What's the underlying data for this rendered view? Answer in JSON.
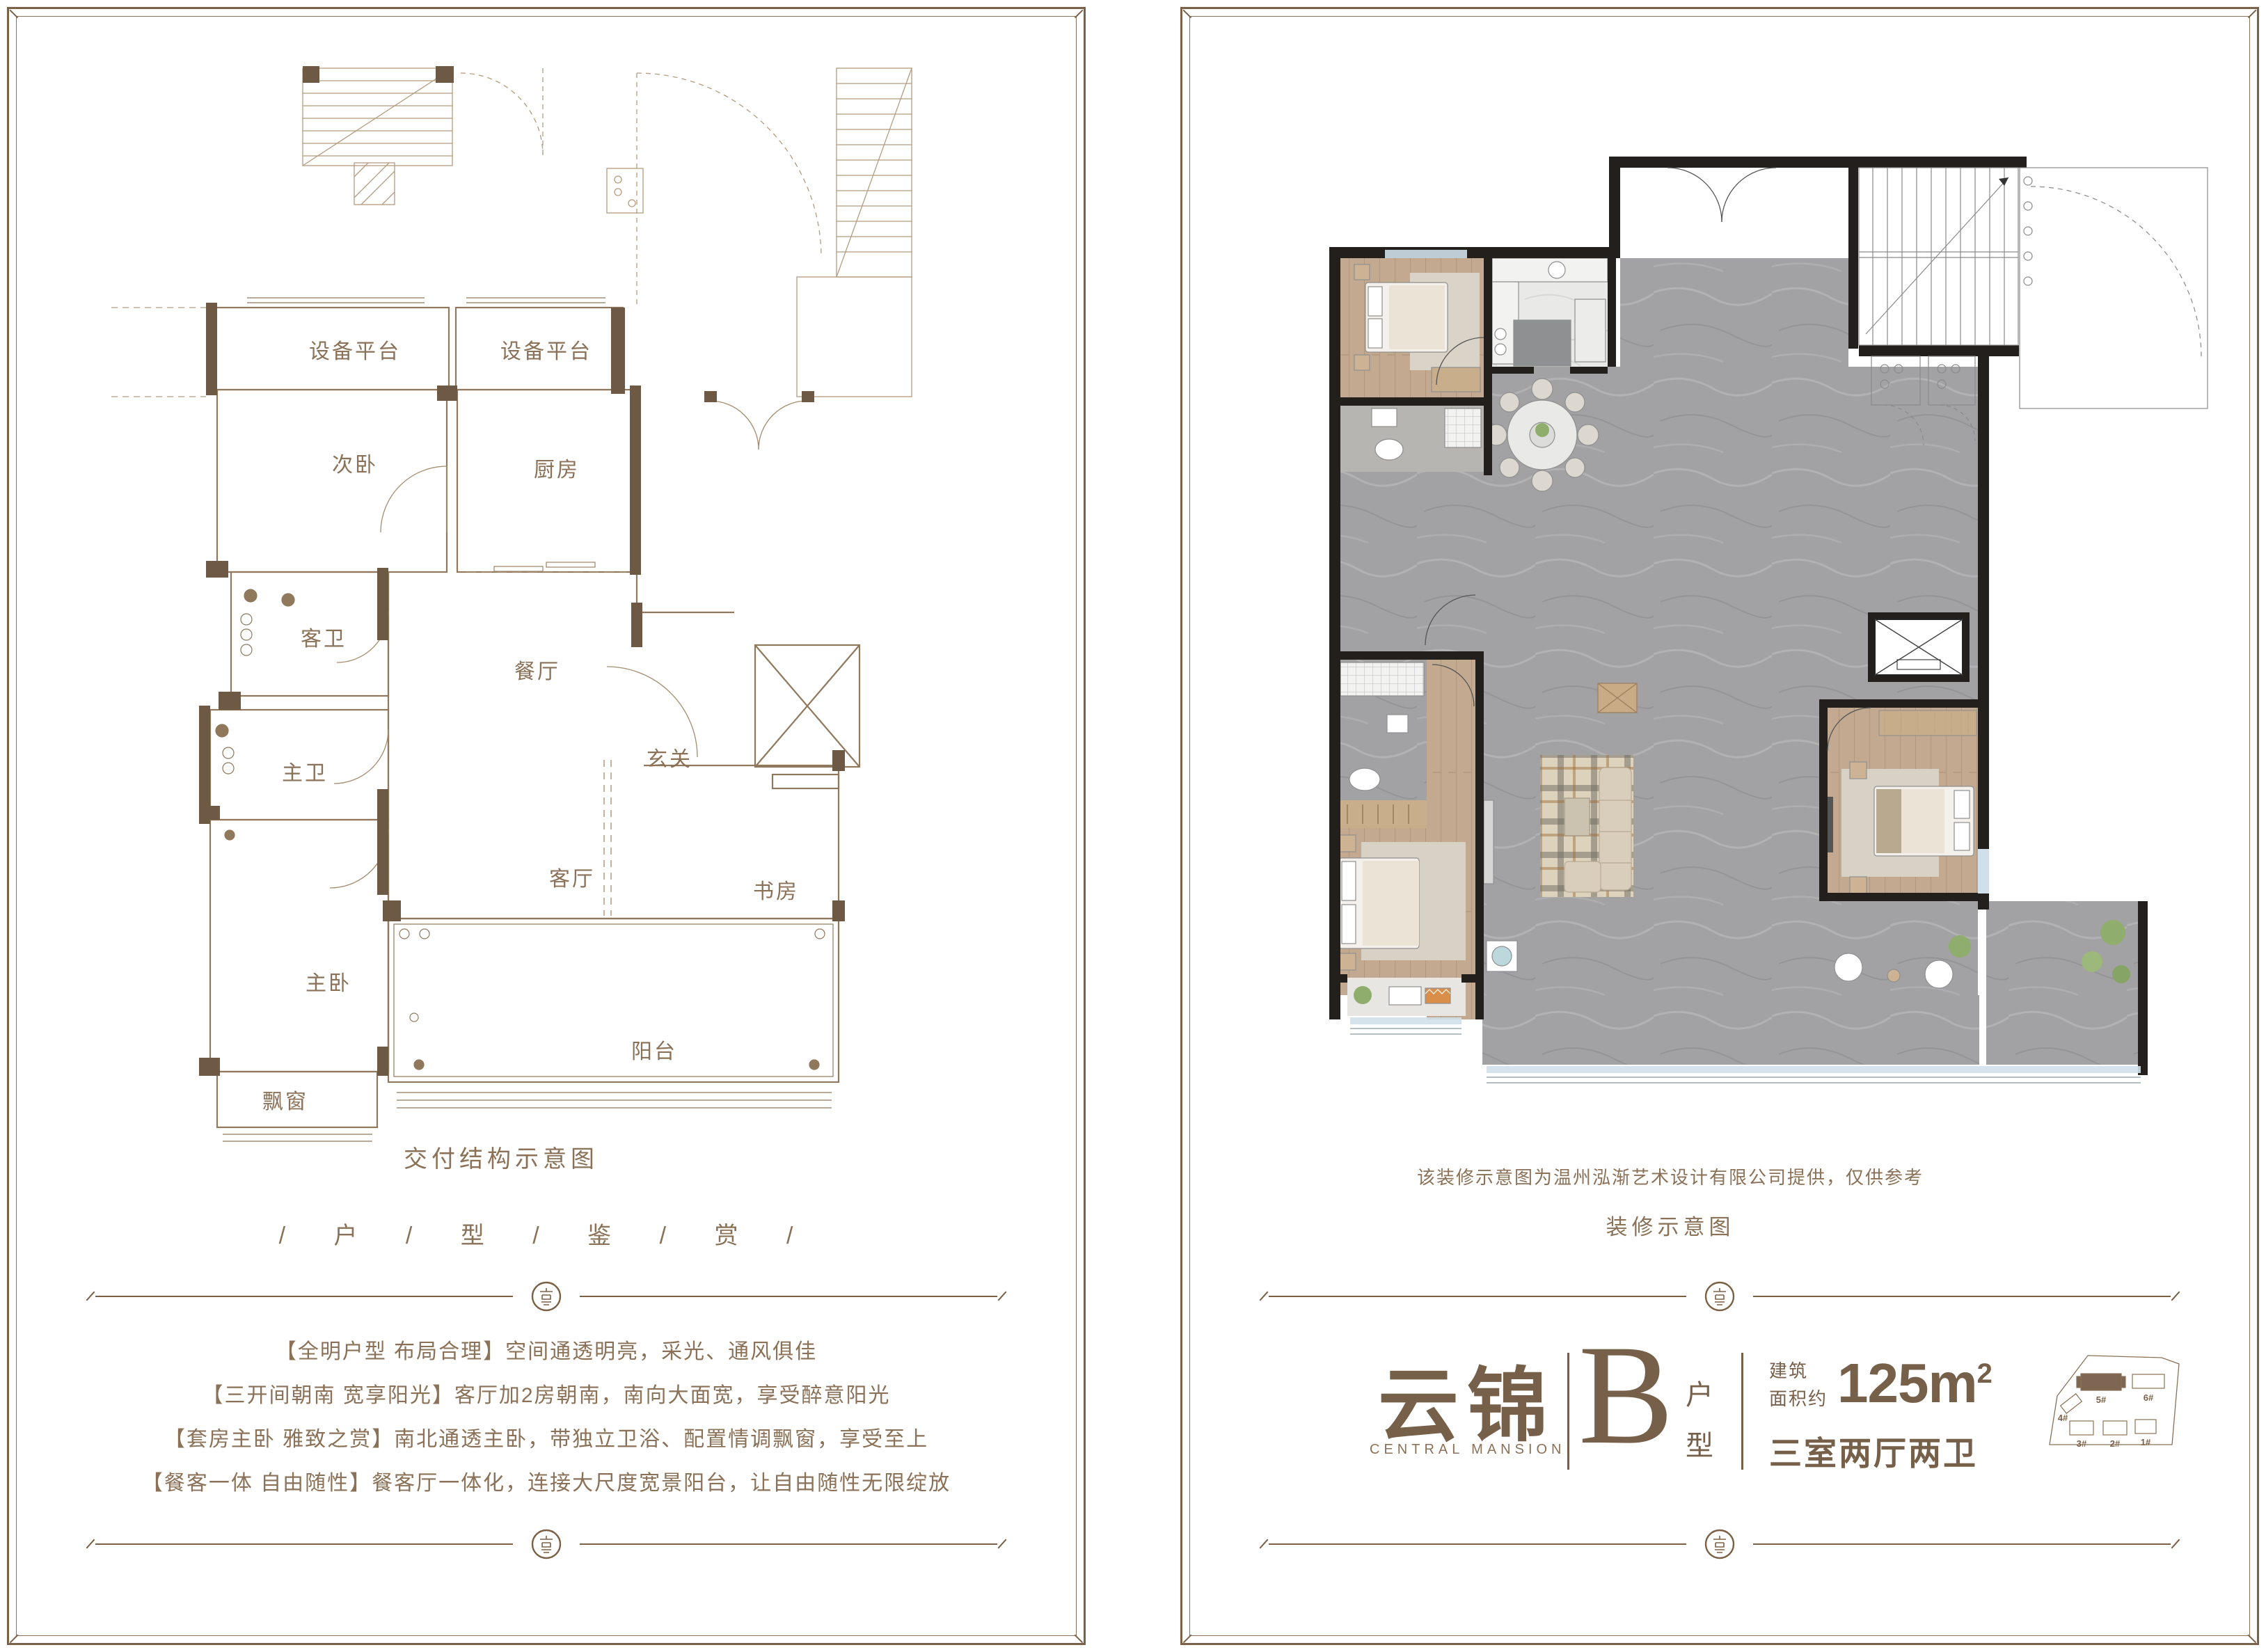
{
  "left_panel": {
    "rooms": [
      "设备平台",
      "设备平台",
      "次卧",
      "厨房",
      "客卫",
      "餐厅",
      "玄关",
      "主卫",
      "主卧",
      "客厅",
      "书房",
      "阳台",
      "飘窗"
    ],
    "caption": "交付结构示意图",
    "series_title": "/ 户 / 型 / 鉴 / 赏 /",
    "features": [
      "【全明户型 布局合理】空间通透明亮，采光、通风俱佳",
      "【三开间朝南 宽享阳光】客厅加2房朝南，南向大面宽，享受醉意阳光",
      "【套房主卧 雅致之赏】南北通透主卧，带独立卫浴、配置情调飘窗，享受至上",
      "【餐客一体 自由随性】餐客厅一体化，连接大尺度宽景阳台，让自由随性无限绽放"
    ]
  },
  "right_panel": {
    "disclaimer": "该装修示意图为温州泓渐艺术设计有限公司提供，仅供参考",
    "caption": "装修示意图",
    "brand": {
      "name": "云锦",
      "name_en": "CENTRAL MANSION",
      "unit_letter": "B",
      "unit_char1": "户",
      "unit_char2": "型",
      "area_label1": "建筑",
      "area_label2": "面积约",
      "area_value": "125m",
      "area_sup": "2",
      "layout": "三室两厅两卫"
    },
    "site_map": {
      "b1": "1#",
      "b2": "2#",
      "b3": "3#",
      "b4": "4#",
      "b5": "5#",
      "b6": "6#"
    }
  },
  "colors": {
    "accent": "#7a6147",
    "wall_brown": "#6e5a44",
    "line_brown": "#8f785c",
    "wall_dark": "#221f1c"
  }
}
